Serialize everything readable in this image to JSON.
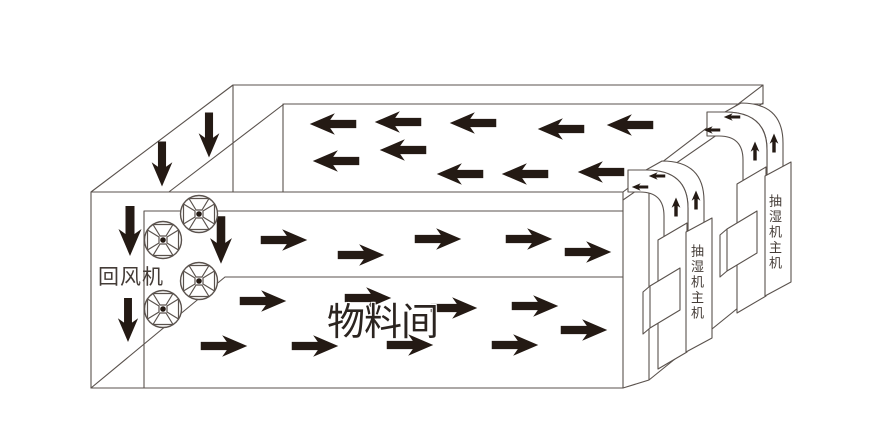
{
  "labels": {
    "return_fan": "回风机",
    "material_room": "物料间",
    "dehumidifier_near": "抽湿机主机",
    "dehumidifier_far": "抽湿机主机"
  },
  "colors": {
    "line": "#5a524d",
    "arrow": "#241a14",
    "label": "#443c37",
    "room_label": "#2b2420"
  },
  "fans": {
    "radius": 18.5,
    "positions": [
      [
        199,
        214
      ],
      [
        163,
        240
      ],
      [
        199,
        281
      ],
      [
        163,
        309
      ]
    ]
  },
  "airflow": {
    "ceiling_return": {
      "direction": "left",
      "scale": 0.93,
      "arrows": [
        [
          333,
          124
        ],
        [
          398,
          122
        ],
        [
          473,
          123
        ],
        [
          561,
          129
        ],
        [
          630,
          125
        ],
        [
          336,
          161
        ],
        [
          403,
          150
        ],
        [
          460,
          174
        ],
        [
          525,
          174
        ],
        [
          601,
          172
        ]
      ]
    },
    "upper_supply": {
      "direction": "right",
      "scale": 0.93,
      "arrows": [
        [
          284,
          240
        ],
        [
          361,
          255
        ],
        [
          438,
          239
        ],
        [
          529,
          239
        ],
        [
          588,
          252
        ]
      ]
    },
    "lower_supply": {
      "direction": "right",
      "scale": 0.93,
      "arrows": [
        [
          263,
          301
        ],
        [
          368,
          298
        ],
        [
          454,
          308
        ],
        [
          535,
          306
        ],
        [
          584,
          330
        ],
        [
          224,
          346
        ],
        [
          315,
          346
        ],
        [
          410,
          345
        ],
        [
          515,
          345
        ]
      ]
    },
    "return_down": {
      "direction": "down",
      "scale": 0.92,
      "arrows": [
        [
          162,
          164,
          0.9
        ],
        [
          209,
          135,
          0.9
        ],
        [
          130,
          231,
          1.0
        ],
        [
          128,
          320,
          0.88
        ],
        [
          221,
          240,
          0.95
        ]
      ]
    },
    "duct_near_outlet": {
      "direction": "left",
      "scale": 0.33,
      "arrows": [
        [
          640,
          187
        ],
        [
          657,
          176
        ]
      ]
    },
    "duct_near_riser": {
      "direction": "up",
      "scale": 0.38,
      "arrows": [
        [
          676,
          207
        ],
        [
          696,
          200
        ]
      ]
    },
    "duct_far_outlet": {
      "direction": "left",
      "scale": 0.33,
      "arrows": [
        [
          712,
          130
        ],
        [
          732,
          117
        ]
      ]
    },
    "duct_far_riser": {
      "direction": "up",
      "scale": 0.38,
      "arrows": [
        [
          755,
          151
        ],
        [
          774,
          143
        ]
      ]
    }
  }
}
